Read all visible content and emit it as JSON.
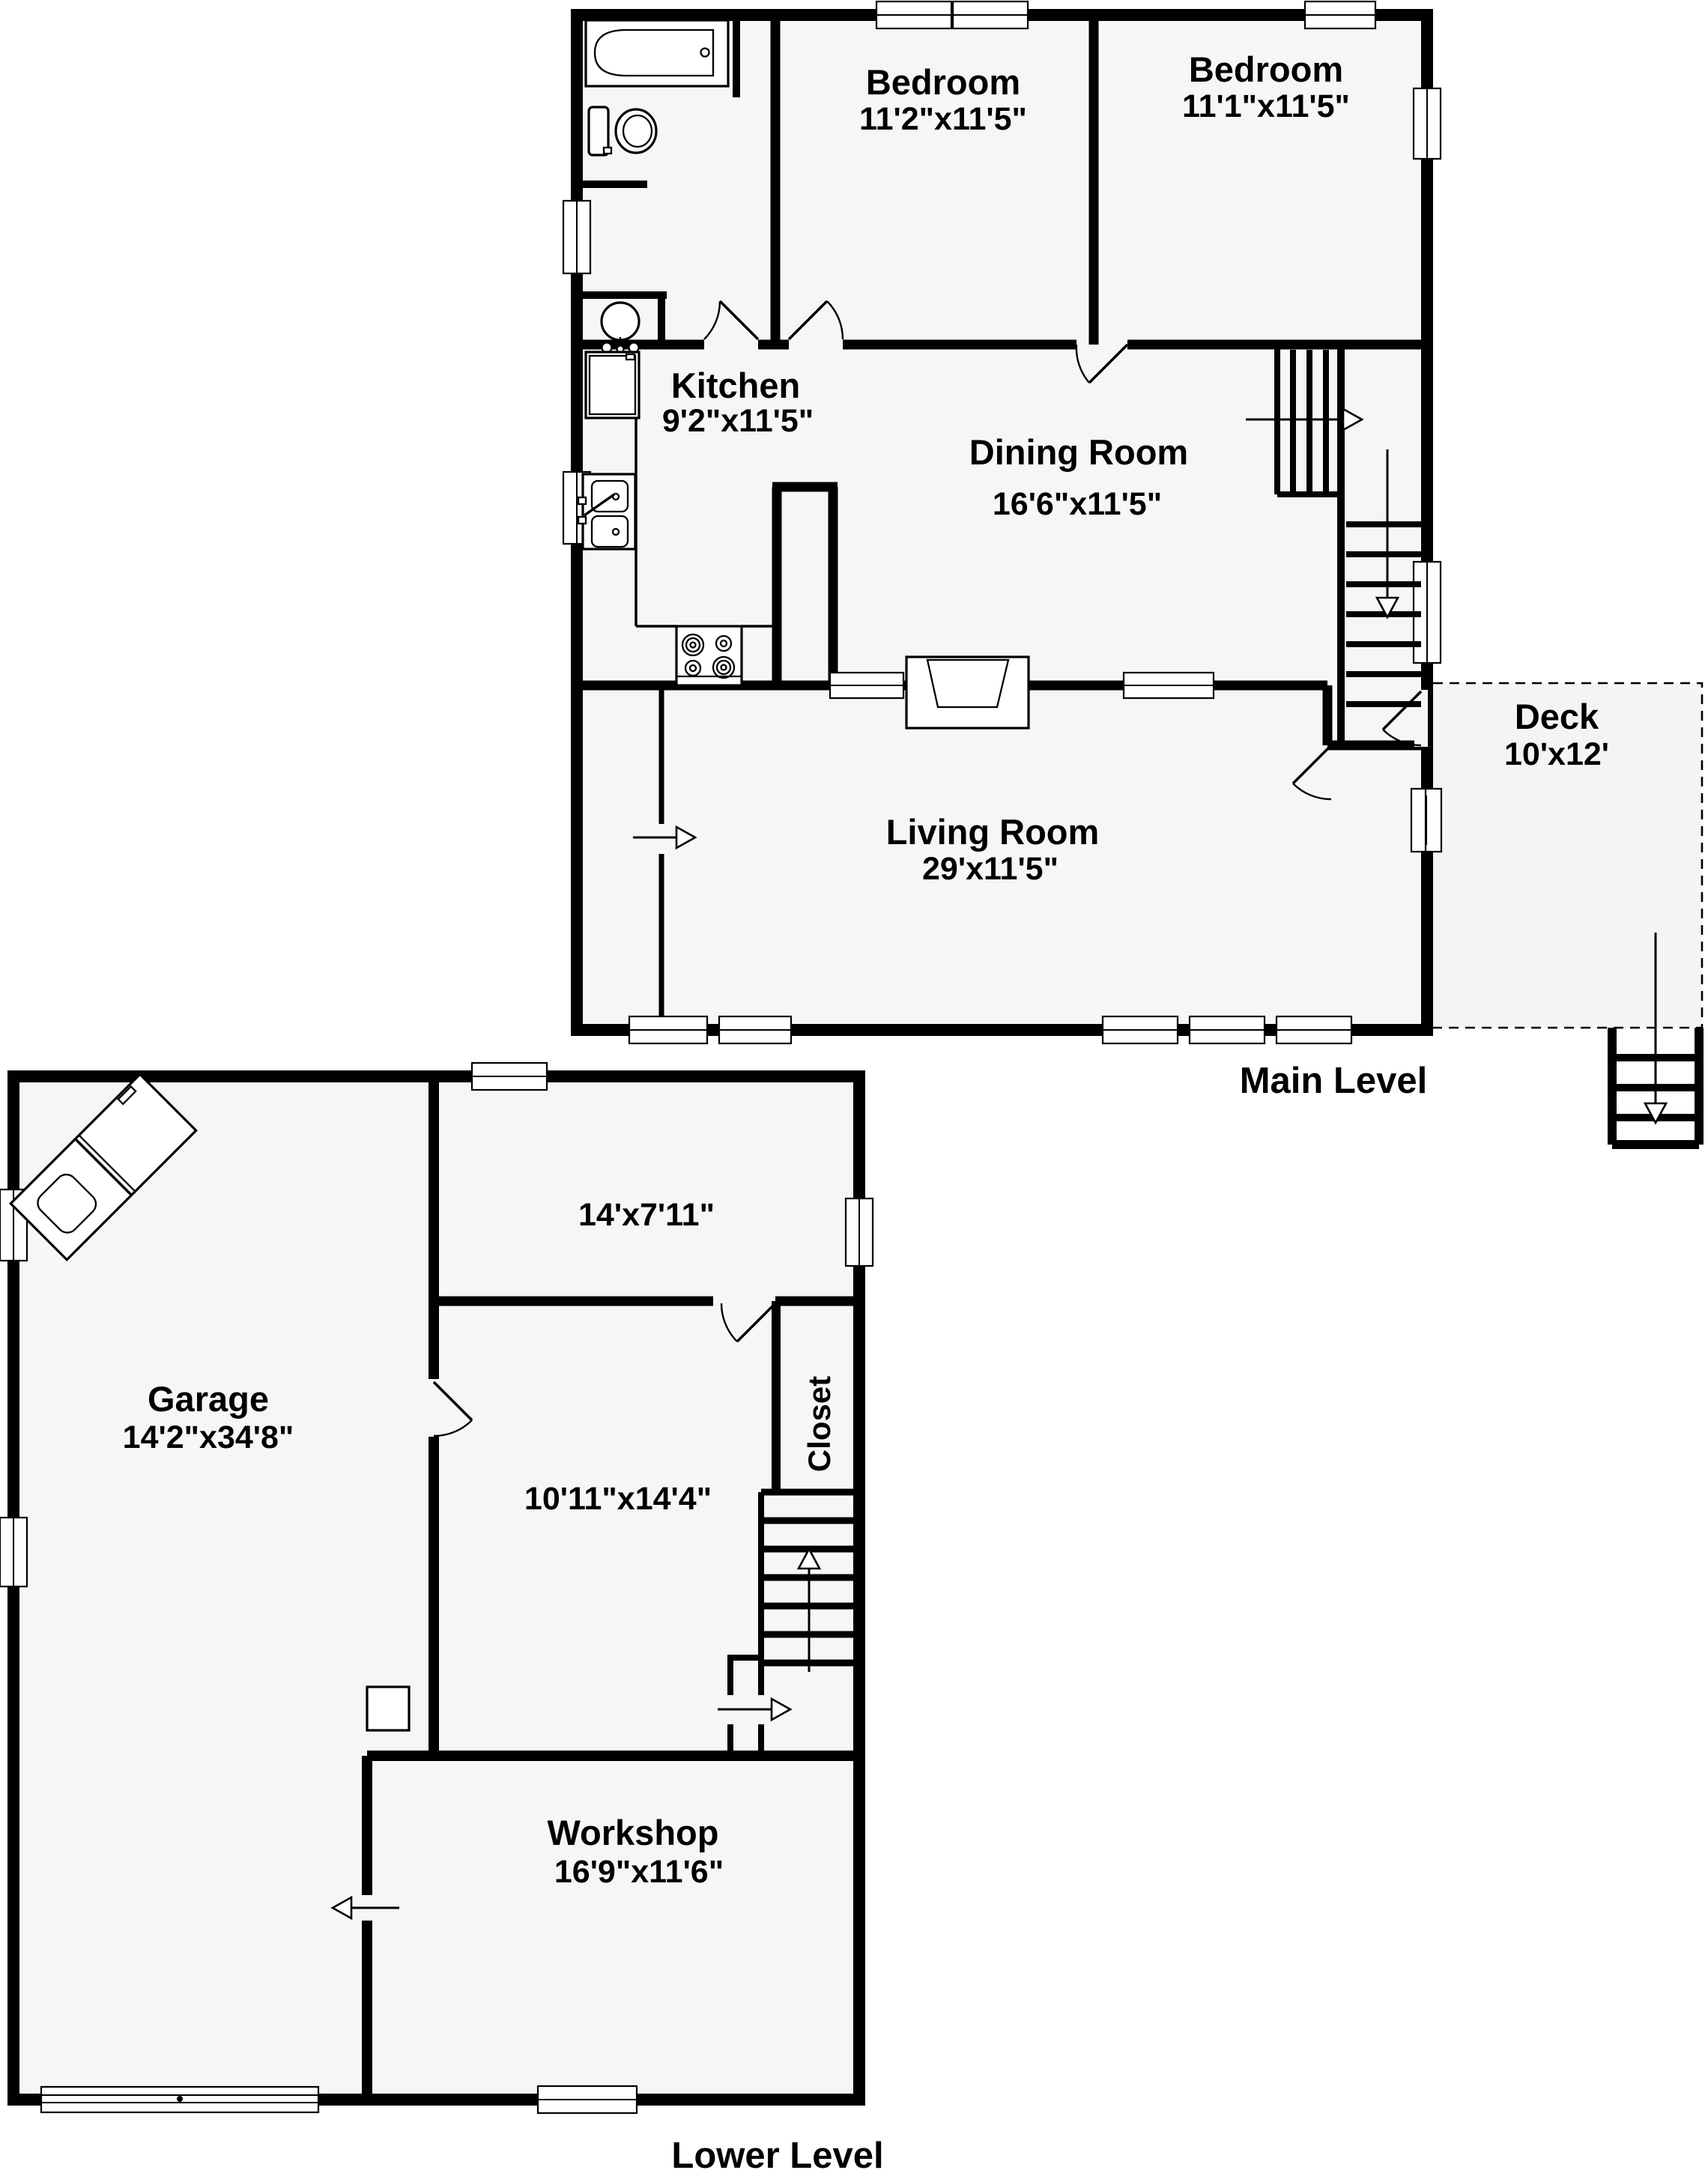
{
  "colors": {
    "wall": "#000000",
    "floor": "#f6f6f6",
    "background": "#ffffff"
  },
  "main_level": {
    "caption": "Main Level",
    "rooms": {
      "bedroom1": {
        "name": "Bedroom",
        "dims": "11'2\"x11'5\""
      },
      "bedroom2": {
        "name": "Bedroom",
        "dims": "11'1\"x11'5\""
      },
      "kitchen": {
        "name": "Kitchen",
        "dims": "9'2\"x11'5\""
      },
      "dining_room": {
        "name": "Dining Room",
        "dims": "16'6\"x11'5\""
      },
      "living_room": {
        "name": "Living Room",
        "dims": "29'x11'5\""
      },
      "deck": {
        "name": "Deck",
        "dims": "10'x12'"
      }
    }
  },
  "lower_level": {
    "caption": "Lower Level",
    "rooms": {
      "garage": {
        "name": "Garage",
        "dims": "14'2\"x34'8\""
      },
      "upper_room": {
        "dims": "14'x7'11\""
      },
      "middle_room": {
        "dims": "10'11\"x14'4\""
      },
      "closet": {
        "name": "Closet"
      },
      "workshop": {
        "name": "Workshop",
        "dims": "16'9\"x11'6\""
      }
    }
  }
}
